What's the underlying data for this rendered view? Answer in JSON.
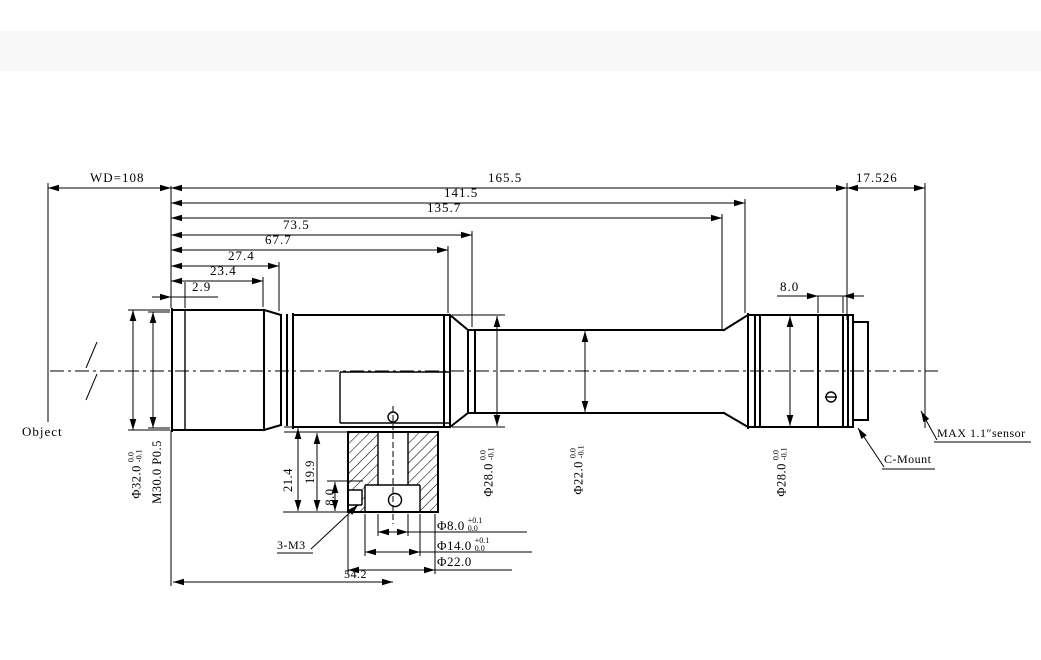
{
  "drawing": {
    "background": "#ffffff",
    "line_color": "#000000",
    "object_label": "Object",
    "top_dims": {
      "wd": "WD=108",
      "total_length": "165.5",
      "flange_focal": "17.526",
      "dim_141_5": "141.5",
      "dim_135_7": "135.7",
      "dim_73_5": "73.5",
      "dim_67_7": "67.7",
      "dim_27_4": "27.4",
      "dim_23_4": "23.4",
      "dim_2_9": "2.9",
      "dim_8_0_rear": "8.0"
    },
    "side_dims": {
      "front_od": {
        "text": "Φ32.0",
        "tol_top": "0.0",
        "tol_bot": "-0.1"
      },
      "front_thread": {
        "text": "M30.0 P0.5"
      },
      "front_barrel_od": {
        "text": "Φ28.0",
        "tol_top": "0.0",
        "tol_bot": "-0.1"
      },
      "tube_od": {
        "text": "Φ22.0",
        "tol_top": "0.0",
        "tol_bot": "-0.1"
      },
      "rear_barrel_od": {
        "text": "Φ28.0",
        "tol_top": "0.0",
        "tol_bot": "-0.1"
      }
    },
    "mount_dims": {
      "dim_21_4": "21.4",
      "dim_19_9": "19.9",
      "dim_8_0_depth": "8.0",
      "thread": "3-M3",
      "dim_54_2": "54.2",
      "bore": {
        "text": "Φ8.0",
        "tol_top": "+0.1",
        "tol_bot": "0.0"
      },
      "counterbore": {
        "text": "Φ14.0",
        "tol_top": "+0.1",
        "tol_bot": "0.0"
      },
      "mount_od": {
        "text": "Φ22.0"
      }
    },
    "annotations": {
      "c_mount": "C-Mount",
      "sensor": "MAX 1.1″sensor"
    }
  }
}
